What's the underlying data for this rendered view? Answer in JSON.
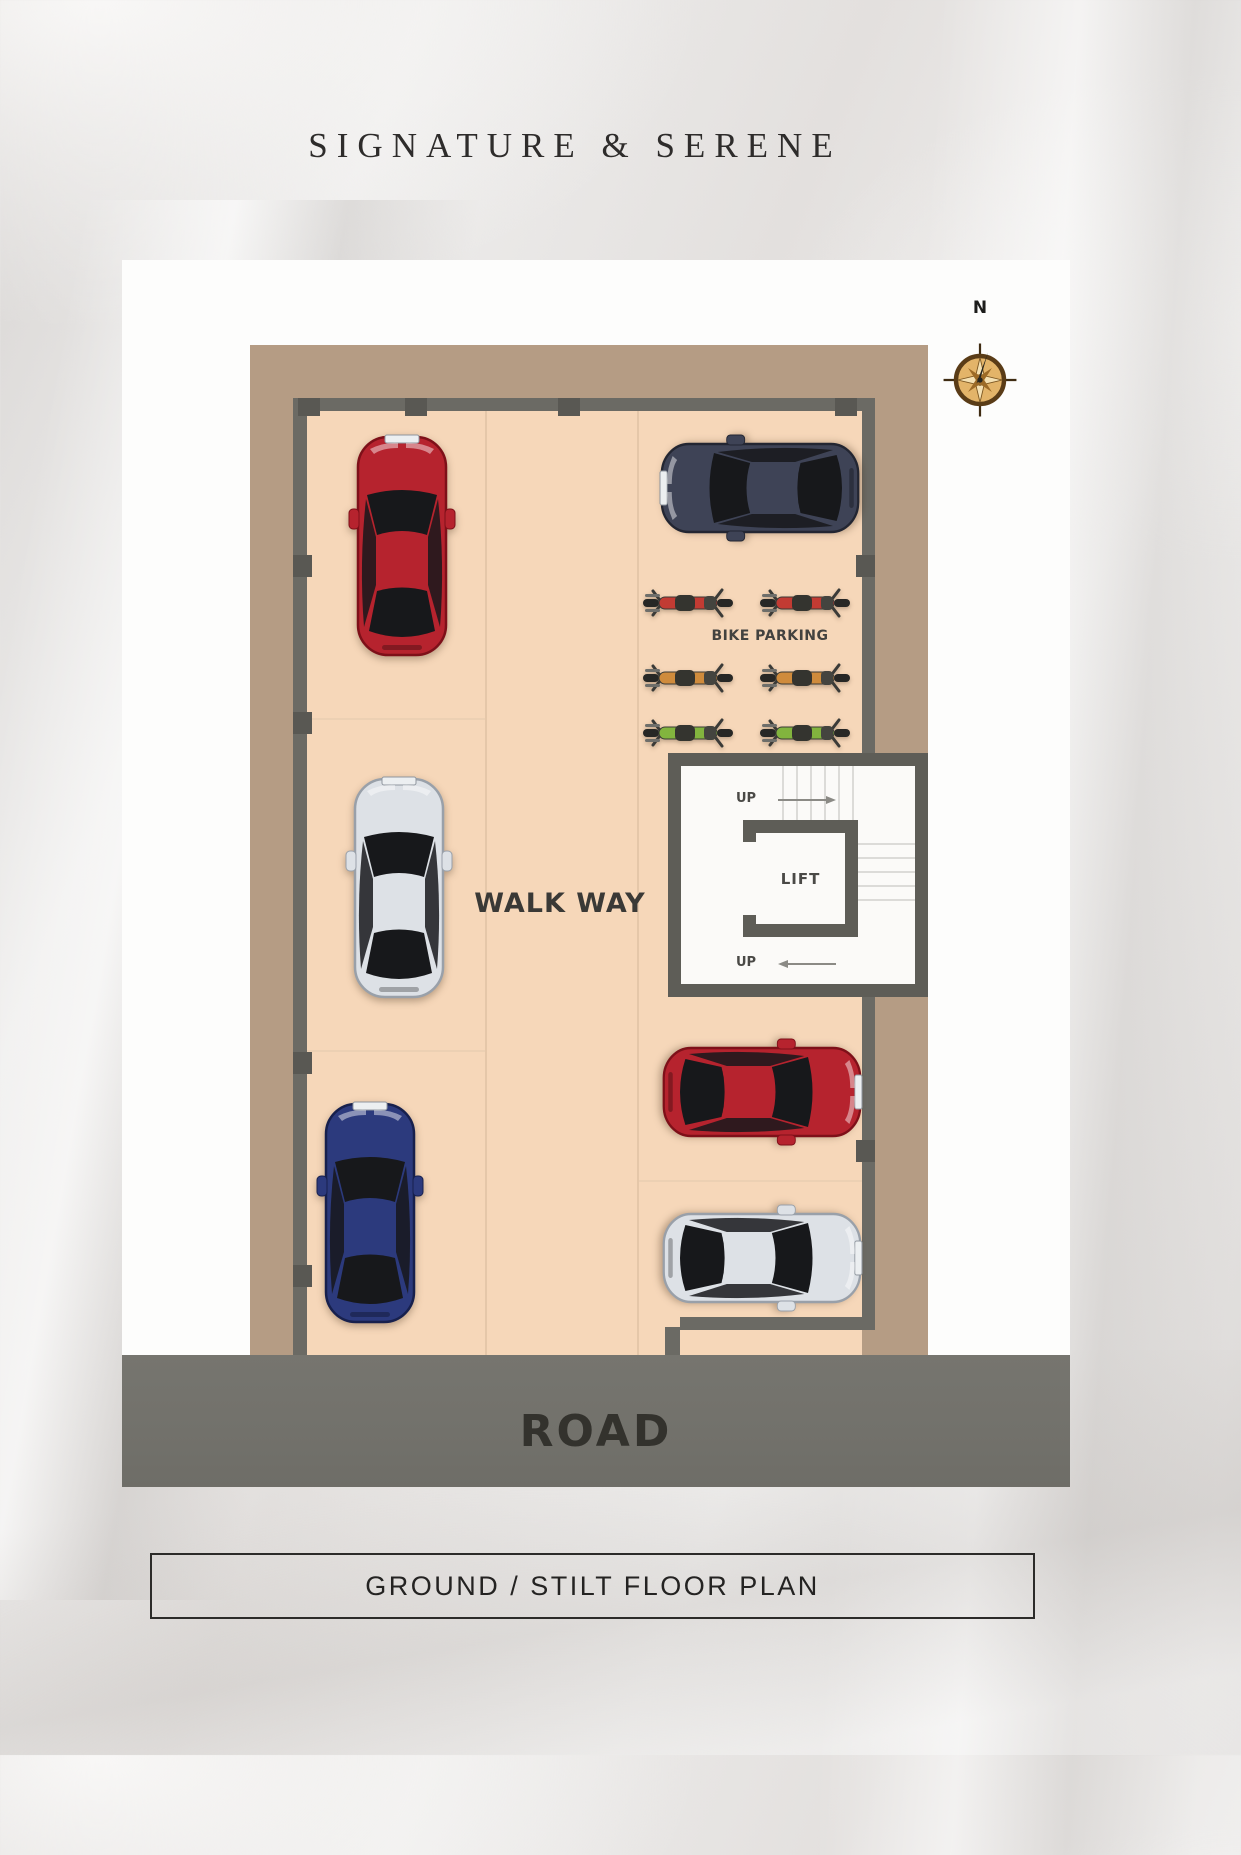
{
  "page": {
    "title": "SIGNATURE & SERENE",
    "footer_caption": "GROUND / STILT FLOOR PLAN"
  },
  "plan": {
    "compass": {
      "label": "N"
    },
    "labels": {
      "bike_parking": "BIKE PARKING",
      "walk_way": "WALK WAY",
      "lift": "LIFT",
      "up": "UP",
      "road": "ROAD"
    },
    "palette": {
      "floor_peach": "#f6d7b9",
      "setback_brown": "#b59c84",
      "wall_gray": "#6b6a64",
      "column_dark": "#595853",
      "road_gray": "#72716b",
      "stair_white": "#fbfaf8"
    },
    "cars": [
      {
        "id": "car-red-left",
        "body": "#b6232e",
        "edge": "#7e1019",
        "orientation": "vertical",
        "facing": "up",
        "cx": 280,
        "cy": 286
      },
      {
        "id": "car-white-left",
        "body": "#dde1e6",
        "edge": "#99a0a9",
        "orientation": "vertical",
        "facing": "up",
        "cx": 277,
        "cy": 628
      },
      {
        "id": "car-blue-left",
        "body": "#2c3a7d",
        "edge": "#17204d",
        "orientation": "vertical",
        "facing": "up",
        "cx": 248,
        "cy": 953
      },
      {
        "id": "car-navy-right",
        "body": "#3e4356",
        "edge": "#232632",
        "orientation": "horizontal",
        "facing": "left",
        "cx": 638,
        "cy": 228
      },
      {
        "id": "car-red-right",
        "body": "#b6232e",
        "edge": "#7e1019",
        "orientation": "horizontal",
        "facing": "right",
        "cx": 640,
        "cy": 832
      },
      {
        "id": "car-white-right",
        "body": "#dde1e6",
        "edge": "#99a0a9",
        "orientation": "horizontal",
        "facing": "right",
        "cx": 640,
        "cy": 998
      }
    ],
    "bikes": [
      {
        "id": "bike-red-1",
        "color": "#c23b33",
        "cx": 566,
        "cy": 343
      },
      {
        "id": "bike-red-2",
        "color": "#c23b33",
        "cx": 683,
        "cy": 343
      },
      {
        "id": "bike-orange-1",
        "color": "#cf8b3c",
        "cx": 566,
        "cy": 418
      },
      {
        "id": "bike-orange-2",
        "color": "#cf8b3c",
        "cx": 683,
        "cy": 418
      },
      {
        "id": "bike-green-1",
        "color": "#82b43e",
        "cx": 566,
        "cy": 473
      },
      {
        "id": "bike-green-2",
        "color": "#82b43e",
        "cx": 683,
        "cy": 473
      }
    ]
  }
}
